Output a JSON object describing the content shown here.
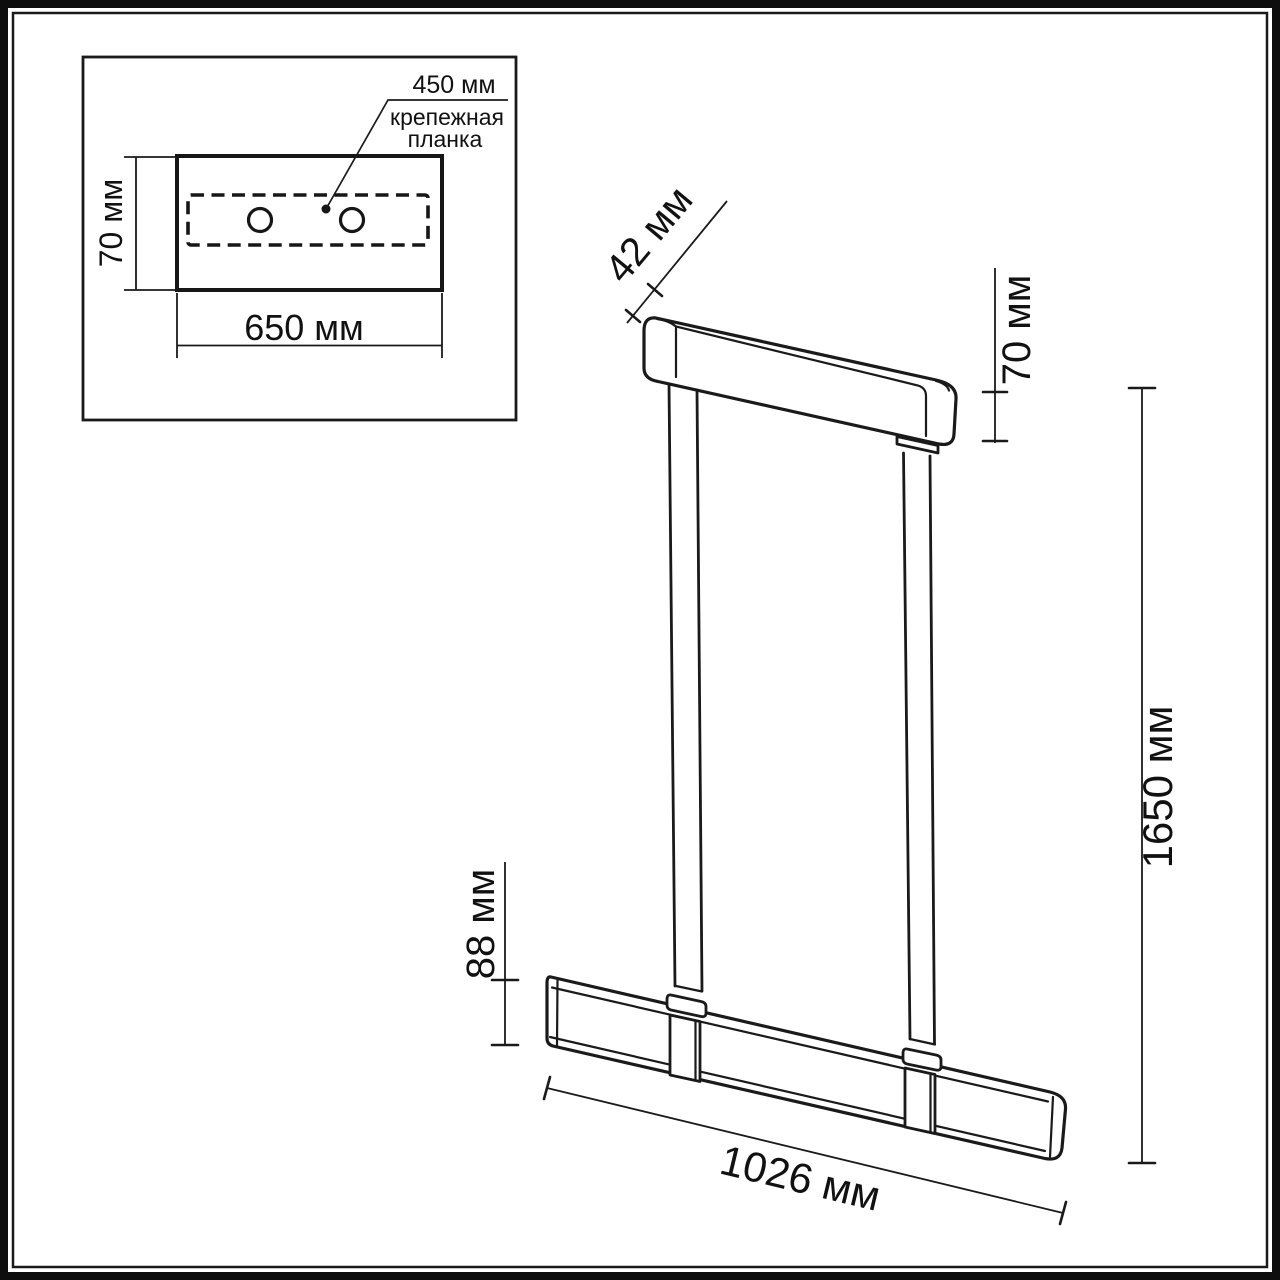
{
  "page": {
    "background": "#ffffff",
    "line_color": "#1a1a1a",
    "text_color": "#111111",
    "units": "мм"
  },
  "inset": {
    "description": "plan view of ceiling mounting plate",
    "plate_width_label": "450 мм",
    "plate_caption_line1": "крепежная",
    "plate_caption_line2": "планка",
    "plate_height_label": "70 мм",
    "plate_length_label": "650 мм"
  },
  "fixture": {
    "description": "perspective view of linear pendant light",
    "canopy_depth_label": "42 мм",
    "canopy_height_label": "70 мм",
    "overall_height_label": "1650 мм",
    "bar_height_label": "88 мм",
    "bar_length_label": "1026 мм"
  }
}
